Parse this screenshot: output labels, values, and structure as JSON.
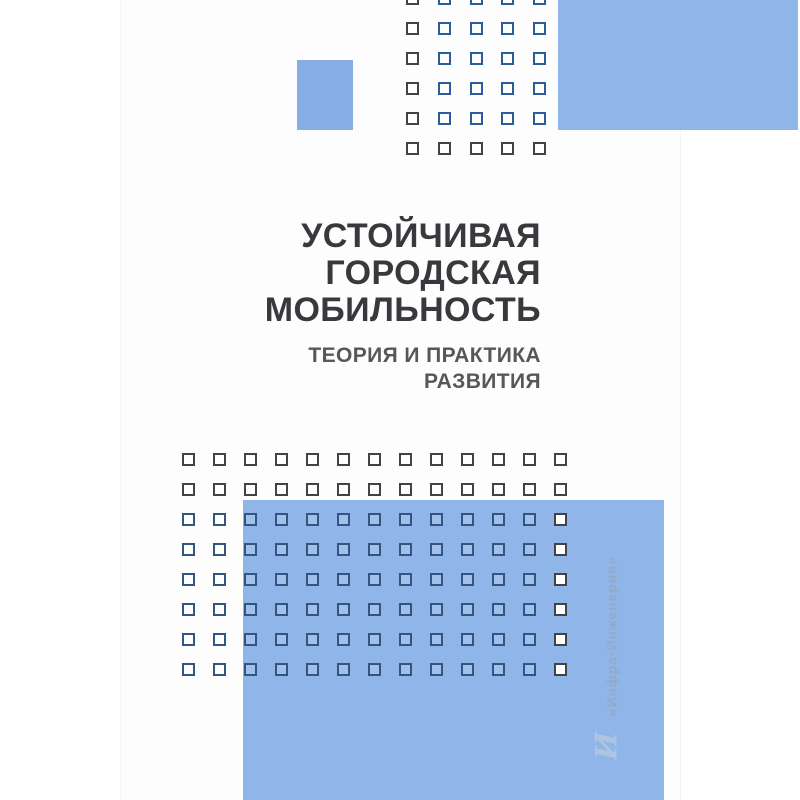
{
  "cover": {
    "title_lines": [
      "УСТОЙЧИВАЯ",
      "ГОРОДСКАЯ",
      "МОБИЛЬНОСТЬ"
    ],
    "subtitle_lines": [
      "ТЕОРИЯ И ПРАКТИКА",
      "РАЗВИТИЯ"
    ],
    "publisher": "«Инфра-Инженерия»",
    "logo_glyph": "И",
    "colors": {
      "panel_blue": "#8fb5e9",
      "small_rect_blue": "#86ade6",
      "square_outline_on_white": "#434345",
      "square_outline_on_blue_top": "#2b5c9c",
      "square_outline_on_blue_bottom": "#33557f",
      "square_fill_on_blue": "rgba(255,255,255,0.16)",
      "title_color": "#39393d",
      "subtitle_color": "#57575b",
      "publisher_color": "#92a9c9",
      "logo_color": "#b9cadf"
    },
    "grids": [
      {
        "target": "top-grid",
        "cols": 5,
        "rows": 6,
        "x": 406,
        "y": -8,
        "dx": 31.75,
        "dy": 30,
        "size": 13,
        "blue_zone": {
          "left": 437,
          "top": -20,
          "right": 677,
          "bottom": 130
        },
        "blue_class": "sq-blue-top"
      },
      {
        "target": "bottom-grid",
        "cols": 13,
        "rows": 8,
        "x": 182,
        "y": 453,
        "dx": 31,
        "dy": 30,
        "size": 13,
        "blue_zone": {
          "left": 122,
          "top": 500,
          "right": 543,
          "bottom": 800
        },
        "blue_class": "sq-blue-bottom"
      }
    ]
  }
}
